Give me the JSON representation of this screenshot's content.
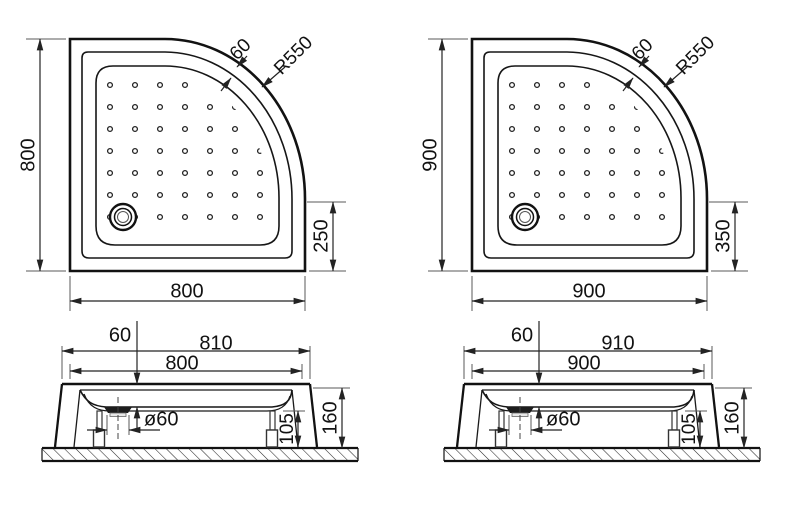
{
  "colors": {
    "line": "#121212",
    "dimension_line": "#232323",
    "extension_line": "#5a5a5a",
    "background": "#ffffff"
  },
  "diagrams": [
    {
      "name": "shower-tray-800",
      "plan": {
        "side": "800",
        "bottom": "800",
        "rim_width": "60",
        "corner_radius": "R550",
        "straight_edge": "250"
      },
      "section": {
        "depth": "60",
        "overall_width": "810",
        "width": "800",
        "drain_diameter": "ø60",
        "leg_height": "105",
        "total_height": "160"
      }
    },
    {
      "name": "shower-tray-900",
      "plan": {
        "side": "900",
        "bottom": "900",
        "rim_width": "60",
        "corner_radius": "R550",
        "straight_edge": "350"
      },
      "section": {
        "depth": "60",
        "overall_width": "910",
        "width": "900",
        "drain_diameter": "ø60",
        "leg_height": "105",
        "total_height": "160"
      }
    }
  ]
}
